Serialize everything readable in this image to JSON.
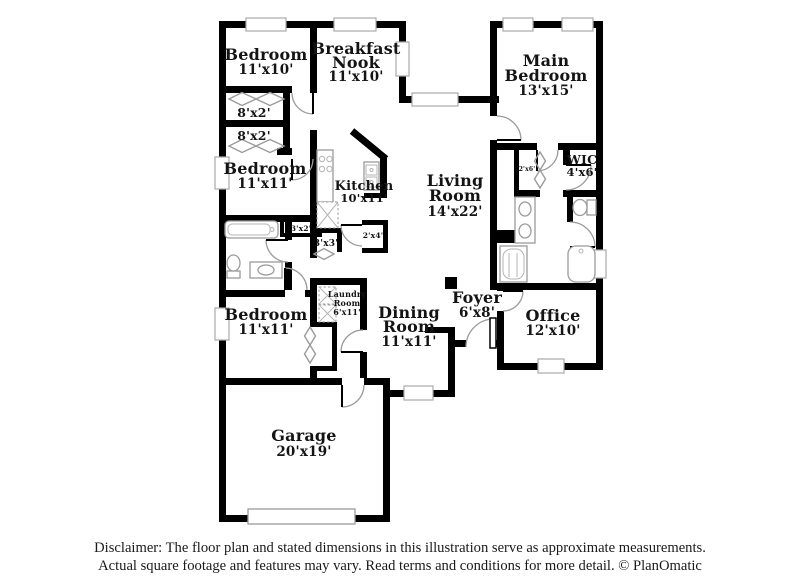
{
  "floor_plan": {
    "labels": [
      {
        "id": "bedroom-top",
        "lines": [
          "Bedroom",
          "11'x10'"
        ]
      },
      {
        "id": "breakfast-nook",
        "lines": [
          "Breakfast",
          "Nook",
          "11'x10'"
        ]
      },
      {
        "id": "main-bedroom",
        "lines": [
          "Main",
          "Bedroom",
          "13'x15'"
        ]
      },
      {
        "id": "closet-8x2-a",
        "lines": [
          "8'x2'"
        ]
      },
      {
        "id": "closet-8x2-b",
        "lines": [
          "8'x2'"
        ]
      },
      {
        "id": "bedroom-middle",
        "lines": [
          "Bedroom",
          "11'x11'"
        ]
      },
      {
        "id": "kitchen",
        "lines": [
          "Kitchen",
          "10'x11'"
        ]
      },
      {
        "id": "living-room",
        "lines": [
          "Living",
          "Room",
          "14'x22'"
        ]
      },
      {
        "id": "closet-2x6",
        "lines": [
          "2'x6'"
        ]
      },
      {
        "id": "wic",
        "lines": [
          "WIC",
          "4'x6'"
        ]
      },
      {
        "id": "closet-3x2",
        "lines": [
          "3'x2'"
        ]
      },
      {
        "id": "closet-3x3",
        "lines": [
          "3'x3'"
        ]
      },
      {
        "id": "closet-2x4",
        "lines": [
          "2'x4'"
        ]
      },
      {
        "id": "bedroom-lower",
        "lines": [
          "Bedroom",
          "11'x11'"
        ]
      },
      {
        "id": "laundry-room",
        "lines": [
          "Laundry",
          "Room",
          "6'x11'"
        ]
      },
      {
        "id": "dining-room",
        "lines": [
          "Dining",
          "Room",
          "11'x11'"
        ]
      },
      {
        "id": "foyer",
        "lines": [
          "Foyer",
          "6'x8'"
        ]
      },
      {
        "id": "office",
        "lines": [
          "Office",
          "12'x10'"
        ]
      },
      {
        "id": "garage",
        "lines": [
          "Garage",
          "20'x19'"
        ]
      }
    ],
    "fixture_icons": [
      "bathtub-icon",
      "shower-icon",
      "toilet-icon",
      "sink-icon",
      "double-vanity-icon",
      "stove-icon",
      "kitchen-sink-icon",
      "pantry-icon",
      "washer-dryer-icon",
      "garage-door-icon",
      "front-door-icon"
    ],
    "colors": {
      "wall": "#000000",
      "fixture_outline": "#9b9b9b",
      "label_text": "#141414",
      "background": "#ffffff"
    }
  },
  "disclaimer": {
    "line1": "Disclaimer: The floor plan and stated dimensions in this illustration serve as approximate measurements.",
    "line2": "Actual square footage and features may vary. Read terms and conditions for more detail. © PlanOmatic"
  }
}
